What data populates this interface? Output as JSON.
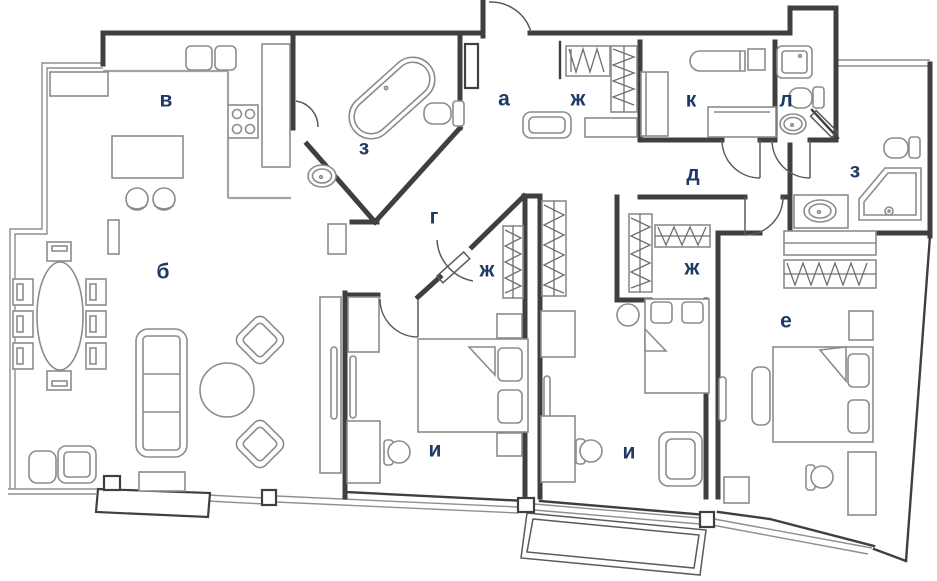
{
  "plan": {
    "type": "apartment-floor-plan"
  },
  "colors": {
    "background": "#ffffff",
    "wall": "#3f3f3f",
    "furniture": "#8c8c8c",
    "counter": "#a3a3a3",
    "door": "#5a5a5a",
    "label": "#1e3a64"
  },
  "rooms": [
    {
      "id": "kitchen",
      "label": "в"
    },
    {
      "id": "bathroom-main",
      "label": "з"
    },
    {
      "id": "hallway-entry",
      "label": "а"
    },
    {
      "id": "closet-entry",
      "label": "ж"
    },
    {
      "id": "utility-room",
      "label": "к"
    },
    {
      "id": "wc",
      "label": "л"
    },
    {
      "id": "corridor-inner",
      "label": "д"
    },
    {
      "id": "bathroom-second",
      "label": "з"
    },
    {
      "id": "corridor-main",
      "label": "г"
    },
    {
      "id": "closet-walkin",
      "label": "ж"
    },
    {
      "id": "closet-middle",
      "label": "ж"
    },
    {
      "id": "living-room",
      "label": "б"
    },
    {
      "id": "bedroom-right",
      "label": "е"
    },
    {
      "id": "bedroom-first",
      "label": "и"
    },
    {
      "id": "bedroom-second",
      "label": "и"
    }
  ]
}
